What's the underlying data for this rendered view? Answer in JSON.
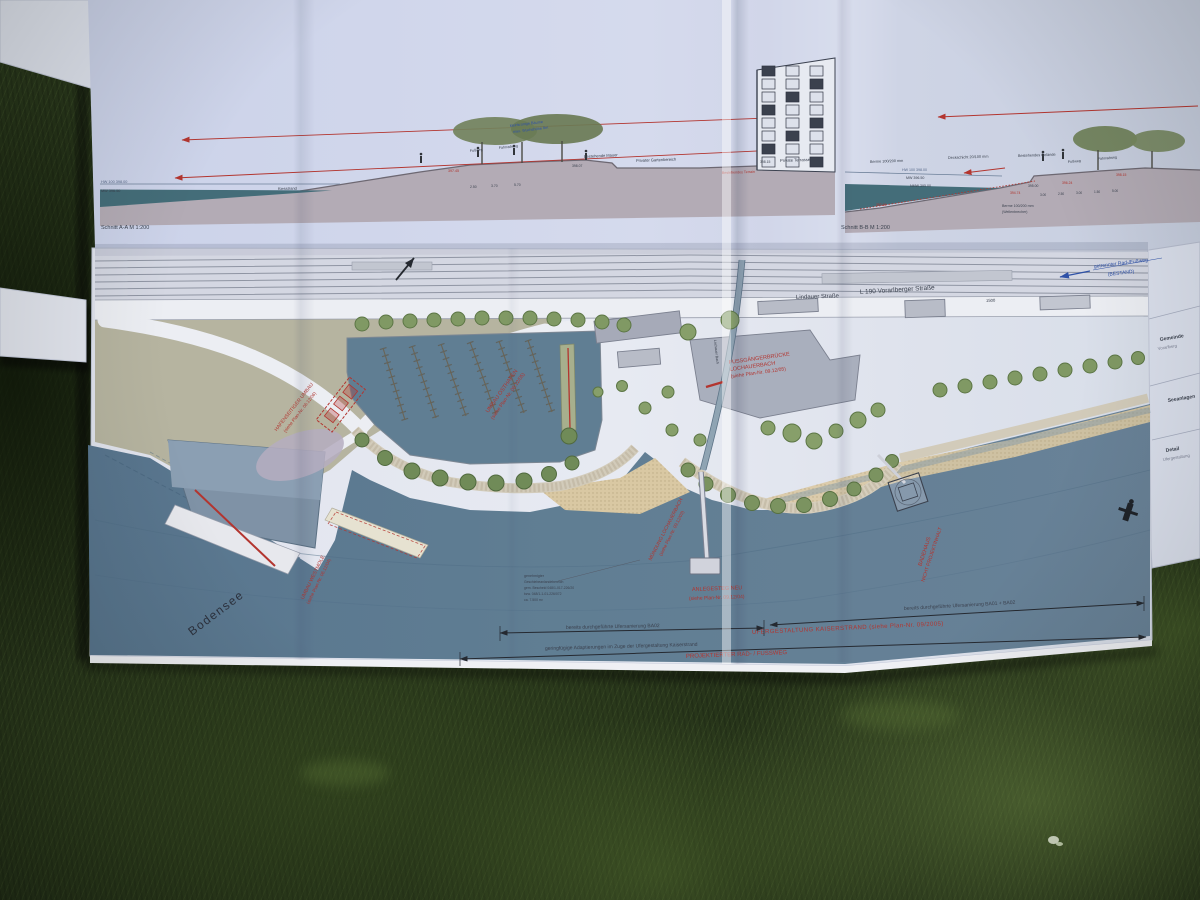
{
  "sections": {
    "a": {
      "caption": "Schnitt A-A M 1:200",
      "hw_label": "HW 100 398.00",
      "mw_label": "MW 396.50",
      "beach_label": "Kiesstrand",
      "path_labels": [
        "Fußweg",
        "Fahrradweg"
      ],
      "tree_note": [
        "kleinkronige Bäume",
        "max. Wuchshöhe 8m"
      ],
      "wall_label": "Bestehende Mauer",
      "garden_label": "Privater Gartenbereich",
      "terrace_label": "Private Terrasse",
      "terrain_label": "Bestehendes Terrain",
      "elevations": [
        "397.45",
        "398.07",
        "398.15"
      ],
      "dims": [
        "2.50",
        "3.70",
        "5.70"
      ]
    },
    "b": {
      "caption": "Schnitt B-B M 1:200",
      "berme_label": "Berme 100/200 mm",
      "deck_label": "Deckschicht 20/100 mm",
      "grade_label": "Bestehendes Gelände",
      "path_labels": [
        "Fußweg",
        "Fahrradweg"
      ],
      "hw_label": "HW 100 398.00",
      "mw_label": "MW 396.50",
      "nmw_label": "NMW 395.00",
      "berme_note": [
        "Berme 100/200 mm",
        "(Wellenbrecher)"
      ],
      "elevations": [
        "394.74",
        "395.00",
        "396.24",
        "398.15",
        "393.60"
      ],
      "dims": [
        "3.00",
        "2.50",
        "3.00",
        "1.50",
        "5.00"
      ]
    }
  },
  "plan": {
    "streets": {
      "lindauer": "Lindauer Straße",
      "l190": "L 190 Vorarlberger Straße",
      "chainage": "1500"
    },
    "bike_note": [
      "getrennter Rad-/Fußweg",
      "(BESTAND)"
    ],
    "lake_label": "Bodensee",
    "stream_label": "Lochauer Bach",
    "red_notes": {
      "hafenseitig": [
        "HAFENSEITIGER UMBAU",
        "(siehe Plan-Nr. 06.12/06)"
      ],
      "osthafen": [
        "UMBAU OSTHAFEN",
        "(siehe Plan-Nr. 06.12/05)"
      ],
      "westmole": [
        "UMBAU WESTMOLE",
        "(siehe Plan-Nr. 06.12/04)"
      ],
      "bruecke": [
        "FUSSGÄNGERBRÜCKE",
        "LOCHAUERBACH",
        "(siehe Plan-Nr. 09.12/05)"
      ],
      "muendung": [
        "MÜNDUNG LOCHAUERBACH",
        "(siehe Plan-Nr. 09.12/03)"
      ],
      "anlegesteg": [
        "ANLEGESTEG NEU",
        "(siehe Plan-Nr. 09.12/04)"
      ],
      "badehaus": [
        "BADEHAUS",
        "NICHT PROJEKTINHALT"
      ],
      "ufergestaltung": "UFERGESTALTUNG KAISERSTRAND (siehe Plan-Nr. 09/2005)",
      "radweg": "PROJEKTIERTER RAD- / FUSSWEG"
    },
    "dims": {
      "ba02": "bereits durchgeführte Ufersanierung BA02",
      "adapt": "geringfügige Adaptierungen im Zuge der Ufergestaltung Kaiserstrand",
      "ba0102": "bereits durchgeführte Ufersanierung BA01 + BA02"
    },
    "note_block": [
      "genehmigter",
      "Geschiebeanlandebereich",
      "gem. Bescheid 048/1-017-226/20",
      "bzw. 048/1-1-01-226/072",
      "ca. 7.500 m²"
    ]
  },
  "title_block": {
    "fragments": [
      "Gemeinde",
      "Vorarlberg",
      "Seeanlagen",
      "Detail",
      "Ufergestaltung"
    ]
  }
}
